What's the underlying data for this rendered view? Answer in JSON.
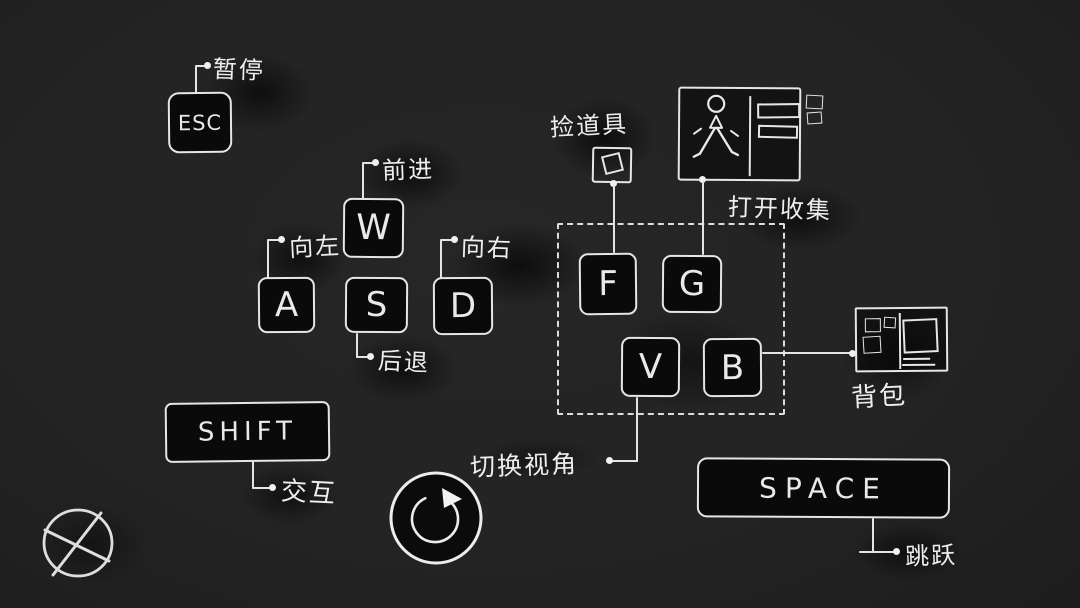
{
  "colors": {
    "background": "#232323",
    "ink": "#e9e9e9",
    "key_fill": "#0a0a0a",
    "smudge": "#0d0d0d"
  },
  "keys": {
    "esc": {
      "label": "ESC",
      "action": "暂停"
    },
    "w": {
      "label": "W",
      "action": "前进"
    },
    "a": {
      "label": "A",
      "action": "向左"
    },
    "s": {
      "label": "S",
      "action": "后退"
    },
    "d": {
      "label": "D",
      "action": "向右"
    },
    "shift": {
      "label": "SHIFT",
      "action": "交互"
    },
    "f": {
      "label": "F",
      "action": "捡道具"
    },
    "g": {
      "label": "G",
      "action": "打开收集"
    },
    "v": {
      "label": "V",
      "action": "切换视角"
    },
    "b": {
      "label": "B",
      "action": "背包"
    },
    "space": {
      "label": "SPACE",
      "action": "跳跃"
    }
  },
  "icons": {
    "item_pickup": "item-box-icon",
    "collection": "collection-window-icon",
    "backpack": "backpack-grid-icon",
    "reset_view": "circular-arrow-icon",
    "close": "crossed-circle-icon"
  }
}
